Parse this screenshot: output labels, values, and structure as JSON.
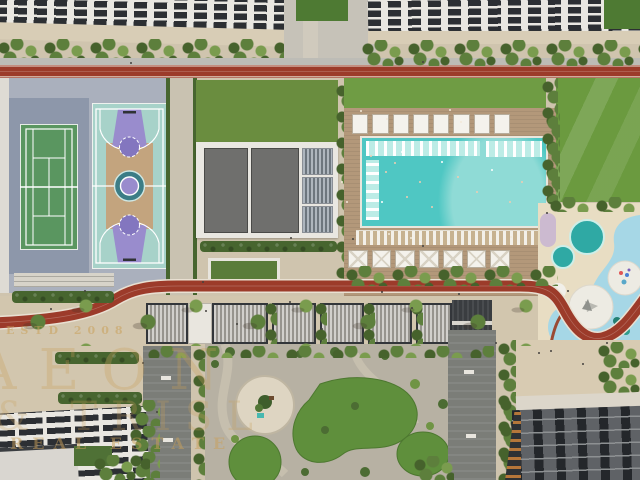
{
  "scene_title": "Aerial rendering of a residential community amenity podium",
  "watermark": {
    "estd": "ESTD 2008",
    "brand": "AEON",
    "brand_line2": "& TRISL",
    "tagline": "REAL ESTATE"
  },
  "amenities": [
    "tennis-court",
    "basketball-court",
    "clubhouse-roof",
    "main-pool",
    "in-pool-loungers",
    "pool-cabanas",
    "kids-splash-pools",
    "playground-circles",
    "running-track",
    "event-lawn",
    "central-garden",
    "pergola-seating",
    "residential-tower-roofs"
  ],
  "counts": {
    "cabanas_north": 8,
    "cabanas_south": 7,
    "kids_pools": 2,
    "play_circles": 2
  },
  "palette": {
    "base": "#cfc4ae",
    "track": "#9c3b2a",
    "trackEdge": "#e9e0d2",
    "pathGray": "#bdbcb6",
    "lawn": "#6f9c44",
    "lawnDark": "#4e7a33",
    "hedge": "#47652f",
    "tree": "#5d7f3c",
    "treeDark": "#46622c",
    "treeLight": "#7a9c4e",
    "courtDeck": "#aab0bd",
    "tennisSurround": "#8d97aa",
    "tennisGreen": "#5a9660",
    "courtLine": "#e6ece6",
    "bballMint": "#a7d2c9",
    "bballPurple": "#998ccd",
    "bballTan": "#c3a47e",
    "bballTeal": "#3c7d86",
    "roofWhite": "#e9e7e1",
    "panelDark": "#2c2f33",
    "roofGray": "#6f6f6d",
    "wood": "#b3987a",
    "cabana": "#f4f2ec",
    "pool": "#4fc7c3",
    "poolLight": "#8adbd3",
    "poolShelf": "#bcece6",
    "kidsBlue": "#a6d7e6",
    "kidsSand": "#e8ddc3",
    "kidsTeal": "#2fa9a4",
    "kidsWhite": "#edebe3",
    "kidsEdge": "#9a4a33",
    "lavender": "#c7b4d2",
    "walkDark": "#7b7d78",
    "gravel": "#b7b1a3",
    "plazaDisc": "#ded5c2",
    "seRoof": "#5f6266",
    "finOrange": "#b5763a",
    "watermark": "#c9a05a"
  }
}
